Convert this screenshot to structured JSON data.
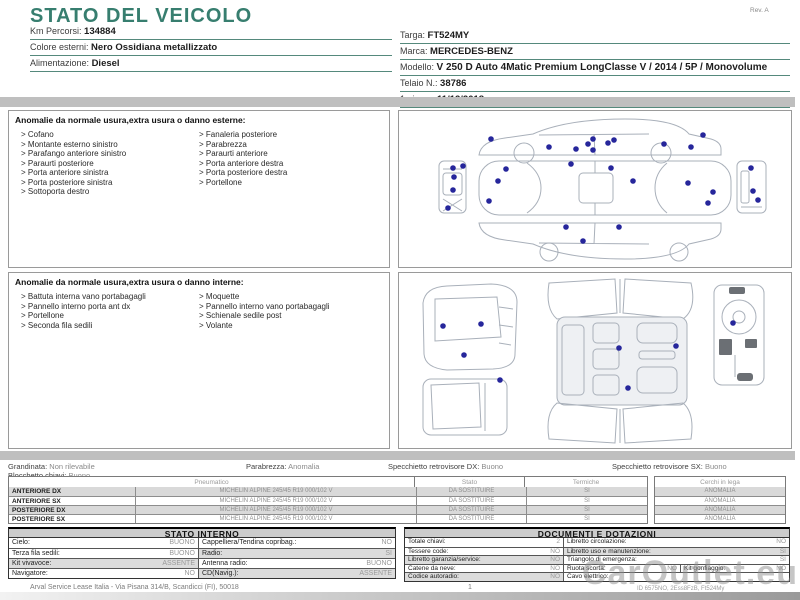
{
  "page": {
    "title": "STATO DEL VEICOLO",
    "rev": "Rev. A",
    "vehicle_left": [
      {
        "label": "Km Percorsi:",
        "value": "134884"
      },
      {
        "label": "Colore esterni:",
        "value": "Nero Ossidiana metallizzato"
      },
      {
        "label": "Alimentazione:",
        "value": "Diesel"
      }
    ],
    "vehicle_right": [
      {
        "label": "Targa:",
        "value": "FT524MY"
      },
      {
        "label": "Marca:",
        "value": "MERCEDES-BENZ"
      },
      {
        "label": "Modello:",
        "value": "V 250 D Auto 4Matic Premium LongClasse V / 2014 / 5P / Monovolume"
      },
      {
        "label": "Telaio N.:",
        "value": "38786"
      },
      {
        "label": "1a imm.:",
        "value": "11/12/2018"
      }
    ]
  },
  "exterior": {
    "title": "Anomalie da normale usura,extra usura o danno esterne:",
    "col1": [
      "Cofano",
      "Montante esterno sinistro",
      "Parafango anteriore sinistro",
      "Paraurti posteriore",
      "Porta anteriore sinistra",
      "Porta posteriore sinistra",
      "Sottoporta destro"
    ],
    "col2": [
      "Fanaleria posteriore",
      "Parabrezza",
      "Paraurti anteriore",
      "Porta anteriore destra",
      "Porta posteriore destra",
      "Portellone"
    ]
  },
  "interior": {
    "title": "Anomalie da normale usura,extra usura o danno interne:",
    "col1": [
      "Battuta interna vano portabagagli",
      "Pannello interno porta ant dx",
      "Portellone",
      "Seconda fila sedili"
    ],
    "col2": [
      "Moquette",
      "Pannello interno vano portabagagli",
      "Schienale sedile post",
      "Volante"
    ]
  },
  "status": [
    {
      "label": "Grandinata:",
      "value": "Non rilevabile"
    },
    {
      "label": "Parabrezza:",
      "value": "Anomalia"
    },
    {
      "label": "Specchietto retrovisore DX:",
      "value": "Buono"
    },
    {
      "label": "Specchietto retrovisore SX:",
      "value": "Buono"
    },
    {
      "label": "Blocchetto chiavi:",
      "value": "Buono"
    }
  ],
  "tyres": {
    "headers": [
      "Pneumatico",
      "Stato",
      "Termiche",
      "Cerchi in lega"
    ],
    "rows": [
      {
        "position": "ANTERIORE DX",
        "spec": "MICHELIN ALPINE 245/45 R19 000/102 V",
        "stato": "DA SOSTITUIRE",
        "termiche": "SI",
        "cerchi": "ANOMALIA"
      },
      {
        "position": "ANTERIORE SX",
        "spec": "MICHELIN ALPINE 245/45 R19 000/102 V",
        "stato": "DA SOSTITUIRE",
        "termiche": "SI",
        "cerchi": "ANOMALIA"
      },
      {
        "position": "POSTERIORE DX",
        "spec": "MICHELIN ALPINE 245/45 R19 000/102 V",
        "stato": "DA SOSTITUIRE",
        "termiche": "SI",
        "cerchi": "ANOMALIA"
      },
      {
        "position": "POSTERIORE SX",
        "spec": "MICHELIN ALPINE 245/45 R19 000/102 V",
        "stato": "DA SOSTITUIRE",
        "termiche": "SI",
        "cerchi": "ANOMALIA"
      }
    ]
  },
  "stato_interno": {
    "title": "STATO INTERNO",
    "rows": [
      {
        "l1": "Cielo:",
        "v1": "BUONO",
        "l2": "Cappelliera/Tendina copribag.:",
        "v2": "NO"
      },
      {
        "l1": "Terza fila sedili:",
        "v1": "BUONO",
        "l2": "Radio:",
        "v2": "SI"
      },
      {
        "l1": "Kit vivavoce:",
        "v1": "ASSENTE",
        "l2": "Antenna radio:",
        "v2": "BUONO"
      },
      {
        "l1": "Navigatore:",
        "v1": "NO",
        "l2": "CD(Navig.):",
        "v2": "ASSENTE"
      }
    ]
  },
  "documenti": {
    "title": "DOCUMENTI E DOTAZIONI",
    "rows": [
      {
        "l1": "Totale chiavi:",
        "v1": "2",
        "l2": "Libretto circolazione:",
        "v2": "NO"
      },
      {
        "l1": "Tessere code:",
        "v1": "NO",
        "l2": "Libretto uso e manutenzione:",
        "v2": "SI"
      },
      {
        "l1": "Libretto garanzia/service:",
        "v1": "NO",
        "l2": "Triangolo di emergenza:",
        "v2": "SI"
      },
      {
        "l1": "Catene da neve:",
        "v1": "NO",
        "l2": "Ruota scorta:",
        "v2": "NO",
        "l3": "Kit gonfiaggio:",
        "v3": "NO"
      },
      {
        "l1": "Codice autoradio:",
        "v1": "NO",
        "l2": "Cavo elettrico:",
        "v2": ""
      }
    ]
  },
  "footer": {
    "company": "Arval Service Lease Italia - Via Pisana 314/B, Scandicci (FI), 50018",
    "page": "1",
    "doc_id": "ID 6575NO, 2Ess8FzB, Ft524My"
  },
  "watermark": "CarOutlet.eu",
  "colors": {
    "accent_teal": "#377e6f",
    "marker_blue": "#26269b",
    "bar_gray": "#bfbfbf"
  }
}
